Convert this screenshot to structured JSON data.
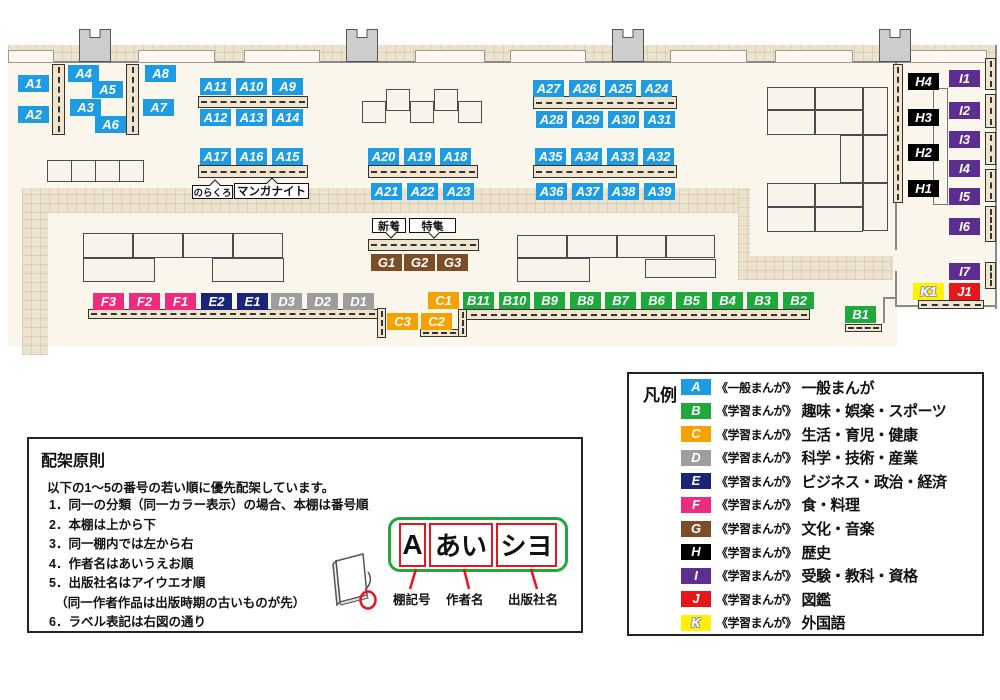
{
  "map": {
    "colors": {
      "A": "#1E9CE3",
      "B": "#1FA83C",
      "C": "#F5A100",
      "D": "#9E9E9F",
      "E": "#1B2577",
      "F": "#EE2C7E",
      "G": "#7C4E27",
      "H": "#000000",
      "I": "#5D2E91",
      "J": "#E7161B",
      "K": "#FFF100"
    },
    "floors": [
      [
        8,
        45,
        889,
        302
      ],
      [
        895,
        45,
        102,
        263
      ]
    ],
    "walkways": [
      [
        8,
        45,
        989,
        17
      ],
      [
        22,
        188,
        26,
        167
      ],
      [
        22,
        188,
        728,
        25
      ],
      [
        738,
        188,
        12,
        92
      ],
      [
        738,
        256,
        155,
        24
      ]
    ],
    "walls": [
      [
        8,
        61,
        989,
        2
      ],
      [
        995,
        45,
        2,
        264
      ],
      [
        895,
        62,
        2,
        188
      ],
      [
        895,
        271,
        2,
        36
      ],
      [
        895,
        305,
        102,
        2
      ],
      [
        883,
        297,
        14,
        2
      ],
      [
        883,
        297,
        2,
        26
      ]
    ],
    "wall_boxes": [
      [
        8,
        50,
        46,
        13
      ],
      [
        138,
        50,
        77,
        13
      ],
      [
        244,
        50,
        76,
        13
      ],
      [
        415,
        50,
        70,
        13
      ],
      [
        510,
        50,
        76,
        13
      ],
      [
        670,
        50,
        77,
        13
      ],
      [
        775,
        50,
        78,
        13
      ],
      [
        903,
        50,
        84,
        13
      ]
    ],
    "pillars": [
      [
        79,
        29,
        32,
        33
      ],
      [
        346,
        29,
        32,
        33
      ],
      [
        612,
        29,
        32,
        33
      ],
      [
        879,
        29,
        32,
        33
      ]
    ],
    "tables": [
      [
        362,
        101,
        24,
        22
      ],
      [
        386,
        89,
        24,
        22
      ],
      [
        410,
        101,
        24,
        22
      ],
      [
        434,
        89,
        24,
        22
      ],
      [
        458,
        101,
        24,
        22
      ],
      [
        47,
        160,
        25,
        22
      ],
      [
        71,
        160,
        25,
        22
      ],
      [
        95,
        160,
        25,
        22
      ],
      [
        119,
        160,
        25,
        22
      ],
      [
        83,
        233,
        50,
        25
      ],
      [
        133,
        233,
        50,
        25
      ],
      [
        183,
        233,
        50,
        25
      ],
      [
        233,
        233,
        50,
        25
      ],
      [
        83,
        258,
        72,
        24
      ],
      [
        212,
        258,
        72,
        24
      ],
      [
        517,
        235,
        50,
        23
      ],
      [
        567,
        235,
        50,
        23
      ],
      [
        617,
        235,
        49,
        23
      ],
      [
        666,
        235,
        49,
        23
      ],
      [
        517,
        258,
        73,
        24
      ],
      [
        645,
        259,
        71,
        19
      ],
      [
        767,
        87,
        48,
        23
      ],
      [
        815,
        87,
        48,
        23
      ],
      [
        863,
        87,
        25,
        48
      ],
      [
        767,
        110,
        48,
        25
      ],
      [
        815,
        110,
        48,
        25
      ],
      [
        840,
        135,
        23,
        48
      ],
      [
        863,
        135,
        25,
        48
      ],
      [
        767,
        183,
        48,
        24
      ],
      [
        815,
        183,
        48,
        24
      ],
      [
        863,
        183,
        25,
        48
      ],
      [
        767,
        207,
        48,
        25
      ],
      [
        815,
        207,
        48,
        25
      ]
    ],
    "shelves_h": [
      [
        198,
        96,
        110,
        12
      ],
      [
        198,
        165,
        110,
        13
      ],
      [
        368,
        165,
        110,
        13
      ],
      [
        533,
        96,
        144,
        13
      ],
      [
        533,
        165,
        144,
        13
      ],
      [
        368,
        239,
        111,
        12
      ],
      [
        88,
        309,
        290,
        10
      ],
      [
        458,
        309,
        352,
        11
      ],
      [
        420,
        329,
        39,
        8
      ],
      [
        845,
        324,
        37,
        8
      ],
      [
        918,
        300,
        66,
        9
      ]
    ],
    "shelves_v": [
      [
        52,
        64,
        13,
        71
      ],
      [
        126,
        64,
        13,
        71
      ],
      [
        377,
        308,
        9,
        30
      ],
      [
        458,
        309,
        9,
        28
      ],
      [
        893,
        64,
        10,
        139
      ],
      [
        985,
        58,
        11,
        32
      ],
      [
        985,
        94,
        11,
        34
      ],
      [
        985,
        132,
        11,
        33
      ],
      [
        985,
        169,
        11,
        33
      ],
      [
        985,
        206,
        11,
        36
      ],
      [
        985,
        262,
        11,
        27
      ]
    ],
    "units": [
      [
        933,
        88,
        15,
        117
      ]
    ],
    "labels": [
      {
        "t": "A1",
        "c": "A",
        "x": 18,
        "y": 75
      },
      {
        "t": "A2",
        "c": "A",
        "x": 18,
        "y": 106
      },
      {
        "t": "A4",
        "c": "A",
        "x": 68,
        "y": 65
      },
      {
        "t": "A3",
        "c": "A",
        "x": 70,
        "y": 99
      },
      {
        "t": "A5",
        "c": "A",
        "x": 92,
        "y": 81
      },
      {
        "t": "A6",
        "c": "A",
        "x": 95,
        "y": 116
      },
      {
        "t": "A8",
        "c": "A",
        "x": 145,
        "y": 65
      },
      {
        "t": "A7",
        "c": "A",
        "x": 143,
        "y": 99
      },
      {
        "t": "A11",
        "c": "A",
        "x": 200,
        "y": 78
      },
      {
        "t": "A10",
        "c": "A",
        "x": 236,
        "y": 78
      },
      {
        "t": "A9",
        "c": "A",
        "x": 272,
        "y": 78
      },
      {
        "t": "A12",
        "c": "A",
        "x": 200,
        "y": 109
      },
      {
        "t": "A13",
        "c": "A",
        "x": 236,
        "y": 109
      },
      {
        "t": "A14",
        "c": "A",
        "x": 272,
        "y": 109
      },
      {
        "t": "A17",
        "c": "A",
        "x": 200,
        "y": 148
      },
      {
        "t": "A16",
        "c": "A",
        "x": 236,
        "y": 148
      },
      {
        "t": "A15",
        "c": "A",
        "x": 272,
        "y": 148
      },
      {
        "t": "A20",
        "c": "A",
        "x": 368,
        "y": 148
      },
      {
        "t": "A19",
        "c": "A",
        "x": 404,
        "y": 148
      },
      {
        "t": "A18",
        "c": "A",
        "x": 440,
        "y": 148
      },
      {
        "t": "A21",
        "c": "A",
        "x": 371,
        "y": 183
      },
      {
        "t": "A22",
        "c": "A",
        "x": 407,
        "y": 183
      },
      {
        "t": "A23",
        "c": "A",
        "x": 443,
        "y": 183
      },
      {
        "t": "A27",
        "c": "A",
        "x": 533,
        "y": 80
      },
      {
        "t": "A26",
        "c": "A",
        "x": 569,
        "y": 80
      },
      {
        "t": "A25",
        "c": "A",
        "x": 605,
        "y": 80
      },
      {
        "t": "A24",
        "c": "A",
        "x": 641,
        "y": 80
      },
      {
        "t": "A28",
        "c": "A",
        "x": 536,
        "y": 111
      },
      {
        "t": "A29",
        "c": "A",
        "x": 572,
        "y": 111
      },
      {
        "t": "A30",
        "c": "A",
        "x": 608,
        "y": 111
      },
      {
        "t": "A31",
        "c": "A",
        "x": 644,
        "y": 111
      },
      {
        "t": "A35",
        "c": "A",
        "x": 535,
        "y": 148
      },
      {
        "t": "A34",
        "c": "A",
        "x": 571,
        "y": 148
      },
      {
        "t": "A33",
        "c": "A",
        "x": 607,
        "y": 148
      },
      {
        "t": "A32",
        "c": "A",
        "x": 643,
        "y": 148
      },
      {
        "t": "A36",
        "c": "A",
        "x": 536,
        "y": 183
      },
      {
        "t": "A37",
        "c": "A",
        "x": 572,
        "y": 183
      },
      {
        "t": "A38",
        "c": "A",
        "x": 608,
        "y": 183
      },
      {
        "t": "A39",
        "c": "A",
        "x": 644,
        "y": 183
      },
      {
        "t": "G1",
        "c": "G",
        "x": 371,
        "y": 254
      },
      {
        "t": "G2",
        "c": "G",
        "x": 404,
        "y": 254
      },
      {
        "t": "G3",
        "c": "G",
        "x": 437,
        "y": 254
      },
      {
        "t": "F3",
        "c": "F",
        "x": 93,
        "y": 293
      },
      {
        "t": "F2",
        "c": "F",
        "x": 129,
        "y": 293
      },
      {
        "t": "F1",
        "c": "F",
        "x": 165,
        "y": 293
      },
      {
        "t": "E2",
        "c": "E",
        "x": 201,
        "y": 293
      },
      {
        "t": "E1",
        "c": "E",
        "x": 237,
        "y": 293
      },
      {
        "t": "D3",
        "c": "D",
        "x": 271,
        "y": 293
      },
      {
        "t": "D2",
        "c": "D",
        "x": 307,
        "y": 293
      },
      {
        "t": "D1",
        "c": "D",
        "x": 343,
        "y": 293
      },
      {
        "t": "C1",
        "c": "C",
        "x": 428,
        "y": 292
      },
      {
        "t": "C3",
        "c": "C",
        "x": 387,
        "y": 313
      },
      {
        "t": "C2",
        "c": "C",
        "x": 421,
        "y": 313
      },
      {
        "t": "B11",
        "c": "B",
        "x": 463,
        "y": 292
      },
      {
        "t": "B10",
        "c": "B",
        "x": 499,
        "y": 292
      },
      {
        "t": "B9",
        "c": "B",
        "x": 534,
        "y": 292
      },
      {
        "t": "B8",
        "c": "B",
        "x": 570,
        "y": 292
      },
      {
        "t": "B7",
        "c": "B",
        "x": 605,
        "y": 292
      },
      {
        "t": "B6",
        "c": "B",
        "x": 641,
        "y": 292
      },
      {
        "t": "B5",
        "c": "B",
        "x": 676,
        "y": 292
      },
      {
        "t": "B4",
        "c": "B",
        "x": 712,
        "y": 292
      },
      {
        "t": "B3",
        "c": "B",
        "x": 747,
        "y": 292
      },
      {
        "t": "B2",
        "c": "B",
        "x": 783,
        "y": 292
      },
      {
        "t": "B1",
        "c": "B",
        "x": 845,
        "y": 306
      },
      {
        "t": "H4",
        "c": "H",
        "x": 908,
        "y": 73
      },
      {
        "t": "H3",
        "c": "H",
        "x": 908,
        "y": 109
      },
      {
        "t": "H2",
        "c": "H",
        "x": 908,
        "y": 144
      },
      {
        "t": "H1",
        "c": "H",
        "x": 908,
        "y": 180
      },
      {
        "t": "I1",
        "c": "I",
        "x": 949,
        "y": 70
      },
      {
        "t": "I2",
        "c": "I",
        "x": 949,
        "y": 102
      },
      {
        "t": "I3",
        "c": "I",
        "x": 949,
        "y": 131
      },
      {
        "t": "I4",
        "c": "I",
        "x": 949,
        "y": 160
      },
      {
        "t": "I5",
        "c": "I",
        "x": 949,
        "y": 188
      },
      {
        "t": "I6",
        "c": "I",
        "x": 949,
        "y": 218
      },
      {
        "t": "I7",
        "c": "I",
        "x": 949,
        "y": 263
      },
      {
        "t": "K1",
        "c": "K",
        "x": 913,
        "y": 283
      },
      {
        "t": "J1",
        "c": "J",
        "x": 949,
        "y": 283
      }
    ],
    "callouts": [
      {
        "t": "のらくろ",
        "x": 192,
        "y": 185,
        "w": 41,
        "h": 14,
        "fs": 9.5,
        "tail": "up"
      },
      {
        "t": "マンガナイト",
        "x": 234,
        "y": 183,
        "w": 75,
        "h": 16,
        "fs": 11.5,
        "tail": "up"
      },
      {
        "t": "新着",
        "x": 372,
        "y": 218,
        "w": 34,
        "h": 15,
        "fs": 11,
        "tail": "down"
      },
      {
        "t": "特集",
        "x": 409,
        "y": 218,
        "w": 47,
        "h": 15,
        "fs": 11,
        "tail": "down"
      }
    ]
  },
  "legend": {
    "title": "凡例",
    "items": [
      {
        "code": "A",
        "scope": "《一般まんが》",
        "name": "一般まんが"
      },
      {
        "code": "B",
        "scope": "《学習まんが》",
        "name": "趣味・娯楽・スポーツ"
      },
      {
        "code": "C",
        "scope": "《学習まんが》",
        "name": "生活・育児・健康"
      },
      {
        "code": "D",
        "scope": "《学習まんが》",
        "name": "科学・技術・産業"
      },
      {
        "code": "E",
        "scope": "《学習まんが》",
        "name": "ビジネス・政治・経済"
      },
      {
        "code": "F",
        "scope": "《学習まんが》",
        "name": "食・料理"
      },
      {
        "code": "G",
        "scope": "《学習まんが》",
        "name": "文化・音楽"
      },
      {
        "code": "H",
        "scope": "《学習まんが》",
        "name": "歴史"
      },
      {
        "code": "I",
        "scope": "《学習まんが》",
        "name": "受験・教科・資格"
      },
      {
        "code": "J",
        "scope": "《学習まんが》",
        "name": "図鑑"
      },
      {
        "code": "K",
        "scope": "《学習まんが》",
        "name": "外国語"
      }
    ]
  },
  "principles": {
    "title": "配架原則",
    "intro": "以下の1～5の番号の若い順に優先配架しています。",
    "lines": [
      "1．同一の分類（同一カラー表示）の場合、本棚は番号順",
      "2．本棚は上から下",
      "3．同一棚内では左から右",
      "4．作者名はあいうえお順",
      "5．出版社名はアイウエオ順",
      "　（同一作者作品は出版時期の古いものが先）",
      "6．ラベル表記は右図の通り"
    ]
  },
  "label_diagram": {
    "fields": [
      {
        "t": "A",
        "w": 27,
        "fs": 28,
        "label": "棚記号",
        "cx": 393
      },
      {
        "t": "あい",
        "w": 64,
        "fs": 26,
        "label": "作者名",
        "cx": 446
      },
      {
        "t": "シヨ",
        "w": 61,
        "fs": 26,
        "label": "出版社名",
        "cx": 508
      }
    ]
  }
}
